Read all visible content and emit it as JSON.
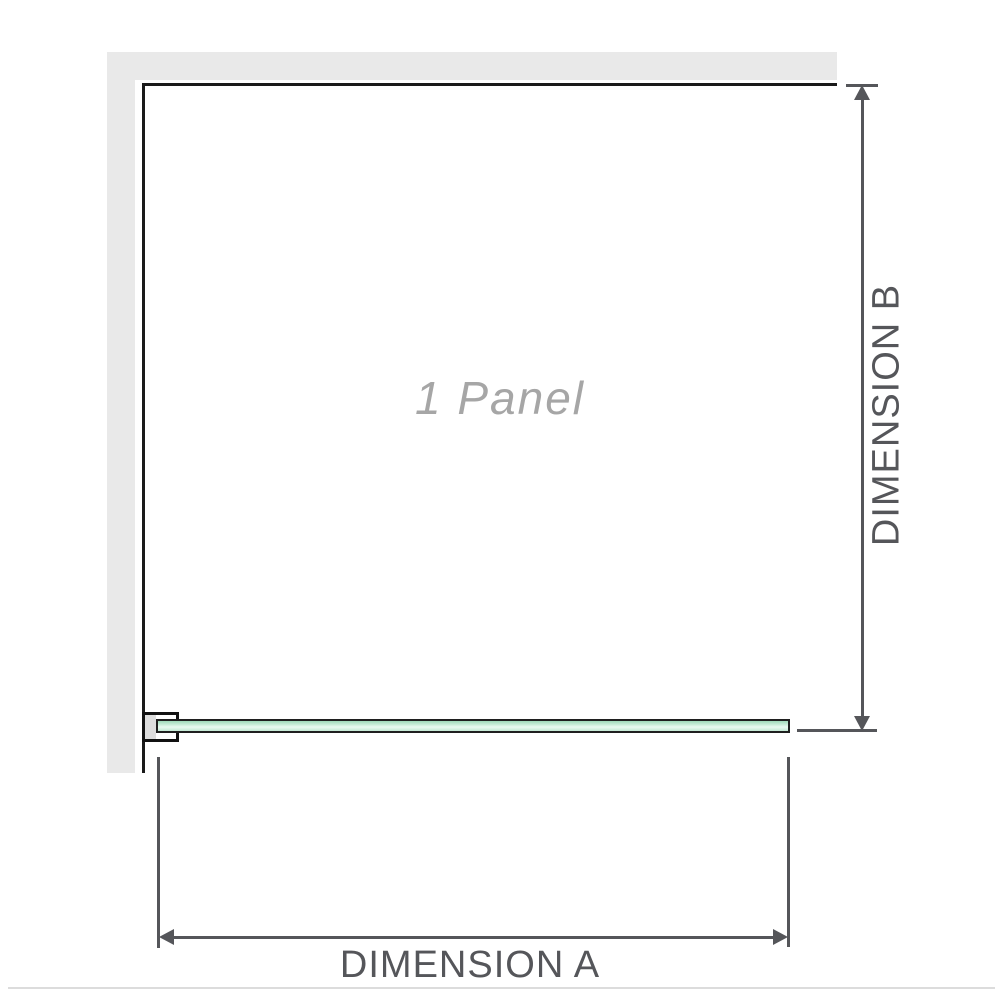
{
  "diagram": {
    "panel_label": "1 Panel",
    "dimension_a_label": "DIMENSION A",
    "dimension_b_label": "DIMENSION B"
  },
  "colors": {
    "wall_fill": "#e9e9e9",
    "wall_edge_line": "#1a1a1a",
    "dimension_line": "#55565a",
    "dimension_text": "#55565a",
    "panel_label_text": "#a6a6a6",
    "glass_fill_top": "#9ed9b8",
    "glass_fill_light": "#eafaf1",
    "glass_fill_bottom": "#c3e9d4",
    "glass_outline": "#1f1f1f",
    "bracket_outline": "#111111",
    "bracket_inner": "#dddddd",
    "divider_line": "#dcdcdc"
  }
}
